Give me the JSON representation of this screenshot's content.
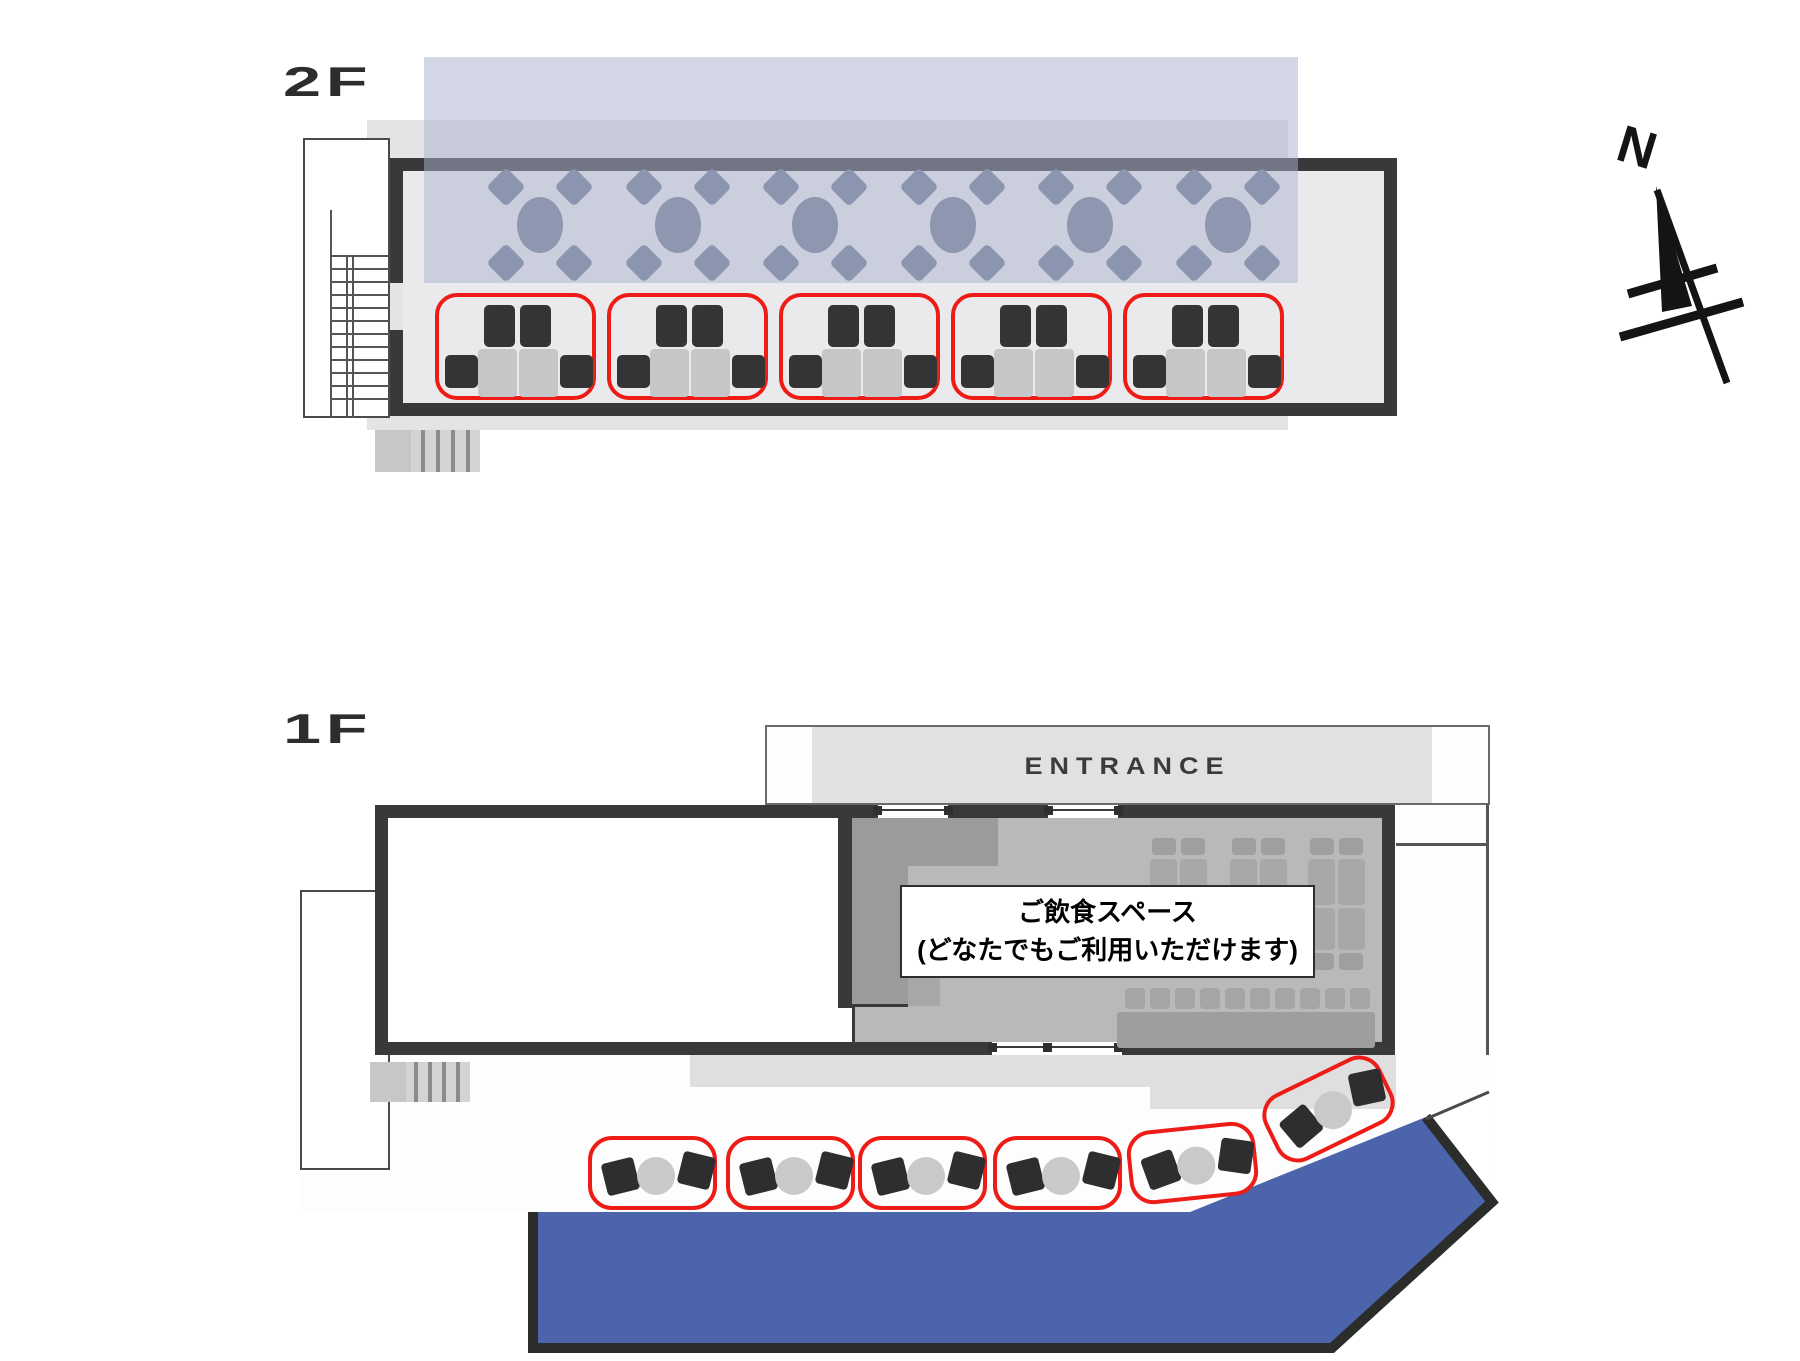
{
  "page": {
    "title": "Facility floor plan 2F / 1F"
  },
  "compass": {
    "north_label": "N"
  },
  "colors": {
    "highlight_red": "#ee1c16",
    "terrace_blue": "#4c64ab",
    "zone_lavender_rgba": "rgba(169,177,206,0.5)",
    "wall_dark": "#39393b"
  },
  "floor_2f": {
    "label": "2F",
    "round_table_count": 6,
    "chairs_per_round_table": 4,
    "booth_count": 5
  },
  "floor_1f": {
    "label": "1F",
    "entrance_label": "ENTRANCE",
    "notice_line1": "ご飲食スペース",
    "notice_line2": "(どなたでもご利用いただけます)",
    "terrace_group_count": 6,
    "counter_chair_count": 10,
    "table_cluster_count": 3
  }
}
